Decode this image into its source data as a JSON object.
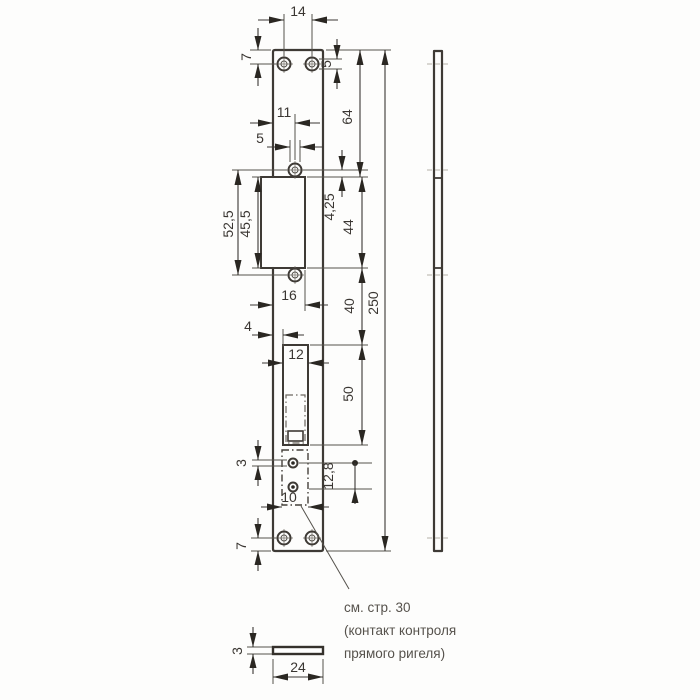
{
  "note": {
    "line1": "см. стр. 30",
    "line2": "(контакт контроля",
    "line3": "прямого ригеля)"
  },
  "dimensions": {
    "top_hole_spacing": "14",
    "top_edge_to_hole": "7",
    "top_hole_diameter": "5",
    "top_to_opening": "64",
    "overall_length": "250",
    "edge_to_mid_hole": "11",
    "mid_hole_diameter": "5",
    "mid_hole_spacing": "52,5",
    "lip_height": "45,5",
    "hole_to_opening_offset": "4,25",
    "opening_height": "44",
    "edge_to_opening_right": "16",
    "opening_to_cutout": "40",
    "edge_to_cutout": "4",
    "cutout_width": "12",
    "cutout_height": "50",
    "contact_hole_diameter": "3",
    "contact_hole_spacing": "12,8",
    "contact_box_width": "10",
    "bottom_edge_to_hole": "7",
    "plate_thickness": "3",
    "plate_width": "24"
  },
  "colors": {
    "line": "#3e3a35",
    "arrow": "#2a2722",
    "text": "#3a3632",
    "note_text": "#56524c",
    "background": "#fdfdfc"
  }
}
